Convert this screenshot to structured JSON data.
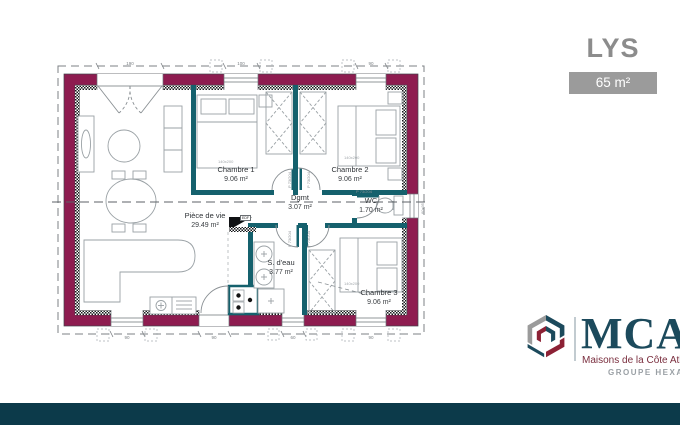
{
  "header": {
    "title": "LYS",
    "area_badge": "65 m²"
  },
  "branding": {
    "wordmark": "MCA",
    "tagline": "Maisons de la Côte Atlantique",
    "group": "GROUPE HEXA",
    "colors": {
      "navy": "#1c4a5c",
      "red": "#8c2135",
      "gray": "#9b9b9b"
    }
  },
  "plan": {
    "rooms": [
      {
        "name": "Pièce de vie",
        "area": "29.49 m²"
      },
      {
        "name": "Chambre 1",
        "area": "9.06 m²"
      },
      {
        "name": "Chambre 2",
        "area": "9.06 m²"
      },
      {
        "name": "Dgmt",
        "area": "3.07 m²"
      },
      {
        "name": "WC",
        "area": "1.70 m²"
      },
      {
        "name": "S. d'eau",
        "area": "3.77 m²"
      },
      {
        "name": "Chambre 3",
        "area": "9.06 m²"
      }
    ],
    "door_label": "P 73/204",
    "bed_label": "140x200",
    "wc_window_label": "60x95",
    "tech_label": "EDF",
    "dims_top": [
      "190",
      "100",
      "90"
    ],
    "dims_bottom": [
      "90",
      "90",
      "60",
      "90"
    ],
    "colors": {
      "exterior_wall": "#8e1c50",
      "partition": "#15616d",
      "footer": "#0c3a4a"
    }
  }
}
